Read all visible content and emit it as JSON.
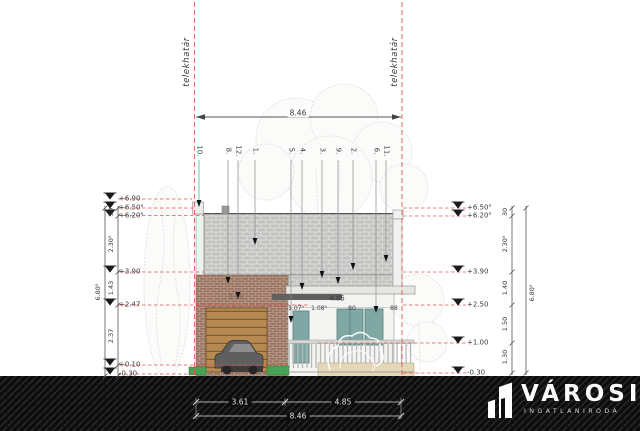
{
  "drawing": {
    "boundary_label_left": "telekhatár",
    "boundary_label_right": "telekhatár",
    "top_dimension": "8.46",
    "leader_numbers": [
      "10.",
      "8.",
      "12.",
      "1.",
      "5.",
      "4.",
      "3.",
      "9.",
      "2.",
      "6.",
      "11."
    ],
    "levels_left": [
      "+6.90",
      "+6.50⁵",
      "+6.20⁵",
      "+3.90",
      "+2.47",
      "+0.10",
      "-0.30"
    ],
    "levels_right": [
      "+6.50⁵",
      "+6.20⁵",
      "+3.90",
      "+2.50",
      "+1.00",
      "-0.30"
    ],
    "chain_left_total": "6.80⁵",
    "chain_left_segments": [
      "30",
      "2.30⁵",
      "1.43",
      "2.37"
    ],
    "chain_right_total": "6.80⁵",
    "chain_right_segments": [
      "30",
      "2.30⁵",
      "1.40",
      "1.50",
      "1.30"
    ],
    "facade": {
      "garage_width": "3.61",
      "porch_width": "4.85",
      "porch_segments": [
        "1.07⁵",
        "1.08⁵",
        "80",
        "88"
      ]
    },
    "bottom_dimensions": {
      "left": "3.61",
      "right": "4.85",
      "total": "8.46"
    }
  },
  "logo": {
    "name": "VÁROSI",
    "subtitle": "INGATLANIRODA"
  },
  "colors": {
    "boundary_red": "#e05555",
    "block_gray": "#c3c3c1",
    "brick_red": "#9b7260",
    "garage_brown": "#b5894f",
    "window_teal": "#7fa8a4",
    "grass_green": "#49a356",
    "planter_tan": "#e3d7b8",
    "ground_black": "#0d0d0d"
  }
}
